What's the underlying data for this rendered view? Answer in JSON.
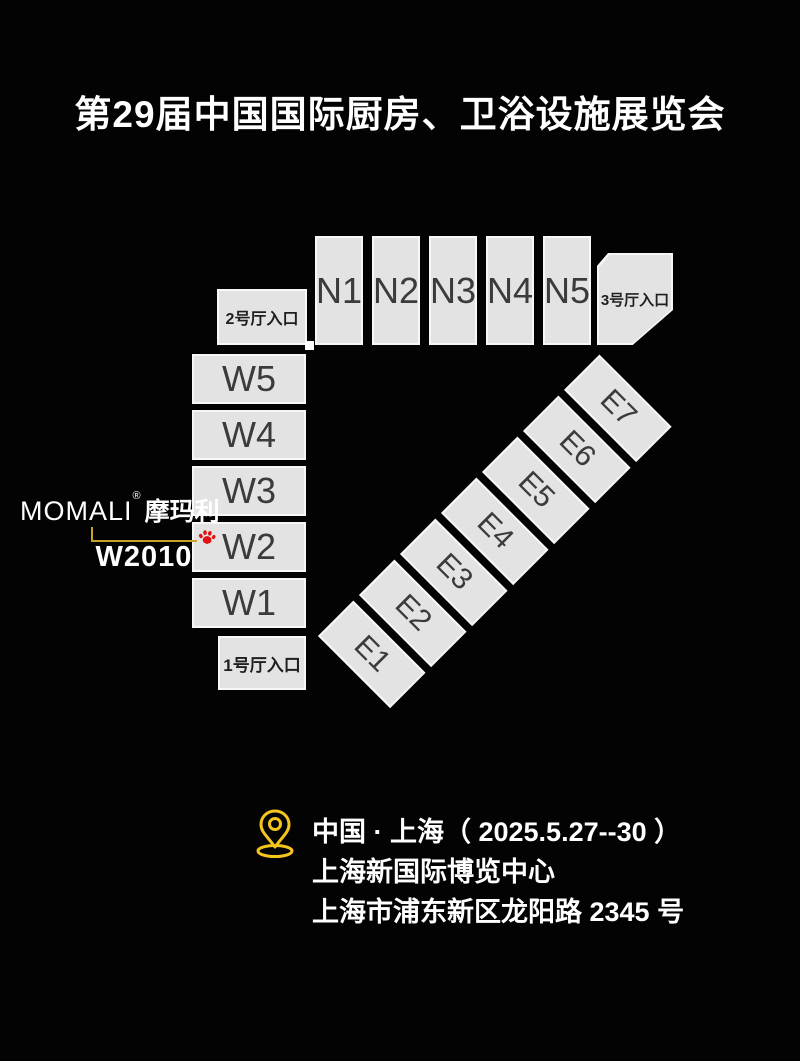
{
  "title": "第29届中国国际厨房、卫浴设施展览会",
  "map": {
    "north_halls": [
      "N1",
      "N2",
      "N3",
      "N4",
      "N5"
    ],
    "west_halls": [
      "W5",
      "W4",
      "W3",
      "W2",
      "W1"
    ],
    "east_halls": [
      "E1",
      "E2",
      "E3",
      "E4",
      "E5",
      "E6",
      "E7"
    ],
    "entrances": {
      "hall1": "1号厅入口",
      "hall2": "2号厅入口",
      "hall3": "3号厅入口"
    }
  },
  "exhibitor": {
    "brand_latin": "MOMALI",
    "registered_mark": "®",
    "brand_cn": "摩玛利",
    "booth": "W2010"
  },
  "venue": {
    "city_date": "中国 · 上海（ 2025.5.27--30 ）",
    "venue_name": "上海新国际博览中心",
    "address": "上海市浦东新区龙阳路 2345 号"
  },
  "icons": {
    "location_pin": "location-pin-icon",
    "paw": "paw-icon"
  },
  "colors": {
    "background": "#000000",
    "hall_fill": "#e3e3e3",
    "hall_border": "#f7f7f7",
    "hall_text": "#3b3b3b",
    "title_text": "#ffffff",
    "connector_yellow": "#c9a227",
    "pin_yellow": "#f5c51d",
    "paw_red": "#e01212",
    "connector_square": "#ffffff"
  }
}
